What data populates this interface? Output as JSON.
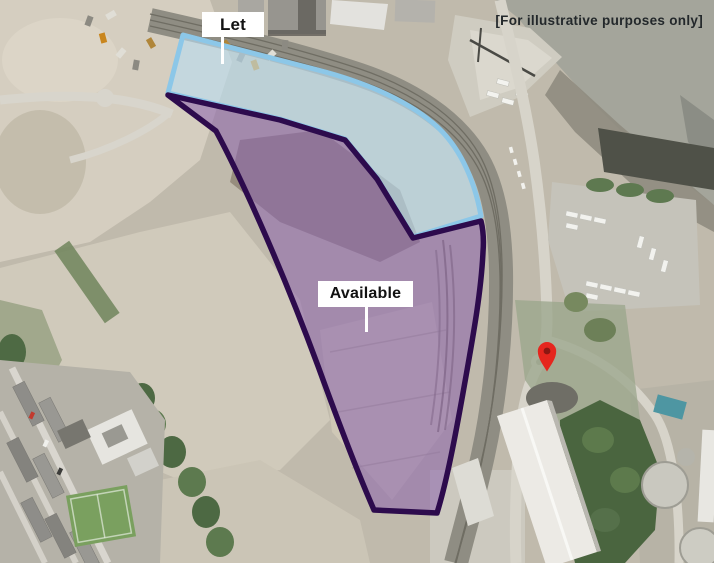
{
  "disclaimer": "[For illustrative purposes only]",
  "legend_regions": [
    {
      "label": "Let",
      "status": "let",
      "fill_color": "#b9ddf0",
      "border_color": "#8cc7e8"
    },
    {
      "label": "Available",
      "status": "available",
      "fill_color": "#8a63ad",
      "border_color": "#2d0b4d"
    }
  ],
  "marker": {
    "name": "location-pin",
    "color": "#e5261e",
    "hole_color": "#8c1712"
  }
}
